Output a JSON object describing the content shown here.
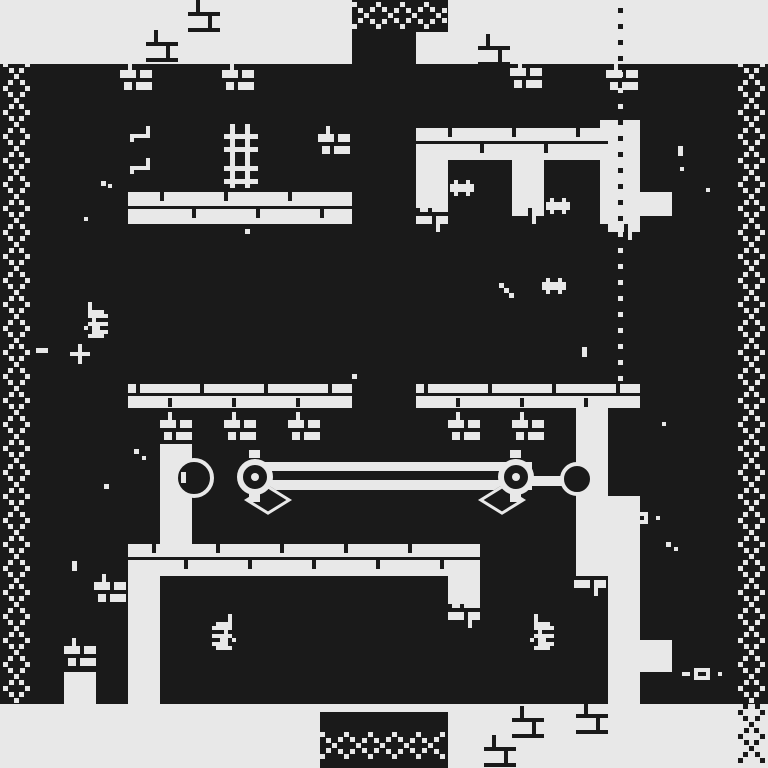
{
  "meta": {
    "title": "1-bit dungeon game screen",
    "description": "Monochrome pixel-art dungeon: brick corridors, chain borders, pulley mechanism, bat creatures, candelabras, keys, dotted route line"
  },
  "palette": {
    "light": "#e8e8e8",
    "dark": "#1a1a1a"
  },
  "regions": [
    {
      "name": "top-band",
      "x": 0,
      "y": 0,
      "w": 768,
      "h": 64,
      "c": "light"
    },
    {
      "name": "bottom-band",
      "x": 0,
      "y": 704,
      "w": 768,
      "h": 64,
      "c": "light"
    },
    {
      "name": "left-corridor",
      "x": 128,
      "y": 192,
      "w": 224,
      "h": 32,
      "c": "light"
    },
    {
      "name": "right-corridor",
      "x": 416,
      "y": 128,
      "w": 192,
      "h": 32,
      "c": "light"
    },
    {
      "name": "right-col-1",
      "x": 416,
      "y": 160,
      "w": 32,
      "h": 48,
      "c": "light"
    },
    {
      "name": "right-col-2",
      "x": 512,
      "y": 160,
      "w": 32,
      "h": 48,
      "c": "light"
    },
    {
      "name": "dot-corridor-top",
      "x": 600,
      "y": 120,
      "w": 40,
      "h": 104,
      "c": "light"
    },
    {
      "name": "left-platform",
      "x": 128,
      "y": 384,
      "w": 224,
      "h": 24,
      "c": "light"
    },
    {
      "name": "right-platform",
      "x": 416,
      "y": 384,
      "w": 224,
      "h": 24,
      "c": "light"
    },
    {
      "name": "mech-left-pillar",
      "x": 160,
      "y": 444,
      "w": 32,
      "h": 100,
      "c": "light"
    },
    {
      "name": "right-wall-col",
      "x": 576,
      "y": 400,
      "w": 32,
      "h": 176,
      "c": "light"
    },
    {
      "name": "dot-corridor-bottom",
      "x": 608,
      "y": 496,
      "w": 32,
      "h": 208,
      "c": "light"
    },
    {
      "name": "mid-band",
      "x": 128,
      "y": 544,
      "w": 352,
      "h": 32,
      "c": "light"
    },
    {
      "name": "bottom-left-col",
      "x": 128,
      "y": 576,
      "w": 32,
      "h": 128,
      "c": "light"
    },
    {
      "name": "bottom-right-col",
      "x": 448,
      "y": 544,
      "w": 32,
      "h": 60,
      "c": "light"
    },
    {
      "name": "right-block-a",
      "x": 640,
      "y": 192,
      "w": 32,
      "h": 24,
      "c": "light"
    },
    {
      "name": "right-block-b",
      "x": 640,
      "y": 640,
      "w": 32,
      "h": 32,
      "c": "light"
    },
    {
      "name": "left-pocket",
      "x": 64,
      "y": 672,
      "w": 32,
      "h": 32,
      "c": "light"
    },
    {
      "name": "top-chain-block",
      "x": 352,
      "y": 0,
      "w": 96,
      "h": 32,
      "c": "dark"
    },
    {
      "name": "center-col-stub",
      "x": 352,
      "y": 32,
      "w": 64,
      "h": 32,
      "c": "dark"
    },
    {
      "name": "bottom-chain-block",
      "x": 320,
      "y": 712,
      "w": 128,
      "h": 56,
      "c": "dark"
    }
  ],
  "bars": [
    {
      "name": "lattice-vbar",
      "x": 230,
      "y": 124,
      "w": 5,
      "h": 64,
      "c": "light"
    },
    {
      "name": "lattice-vbar",
      "x": 245,
      "y": 124,
      "w": 5,
      "h": 64,
      "c": "light"
    },
    {
      "name": "lattice-hbar",
      "x": 224,
      "y": 134,
      "w": 34,
      "h": 5,
      "c": "light"
    },
    {
      "name": "lattice-hbar",
      "x": 224,
      "y": 147,
      "w": 34,
      "h": 5,
      "c": "light"
    },
    {
      "name": "lattice-hbar",
      "x": 224,
      "y": 166,
      "w": 34,
      "h": 5,
      "c": "light"
    },
    {
      "name": "lattice-hbar",
      "x": 224,
      "y": 179,
      "w": 34,
      "h": 5,
      "c": "light"
    },
    {
      "name": "mortar-line",
      "x": 128,
      "y": 393,
      "w": 224,
      "h": 3,
      "c": "dark"
    },
    {
      "name": "mortar-line",
      "x": 416,
      "y": 393,
      "w": 224,
      "h": 3,
      "c": "dark"
    },
    {
      "name": "mortar-line",
      "x": 128,
      "y": 557,
      "w": 352,
      "h": 3,
      "c": "dark"
    },
    {
      "name": "mortar-line",
      "x": 128,
      "y": 206,
      "w": 224,
      "h": 3,
      "c": "dark"
    },
    {
      "name": "mortar-line",
      "x": 416,
      "y": 141,
      "w": 192,
      "h": 3,
      "c": "dark"
    },
    {
      "name": "mortar-tick",
      "x": 136,
      "y": 384,
      "w": 4,
      "h": 9,
      "c": "dark"
    },
    {
      "name": "mortar-tick",
      "x": 200,
      "y": 384,
      "w": 4,
      "h": 9,
      "c": "dark"
    },
    {
      "name": "mortar-tick",
      "x": 264,
      "y": 384,
      "w": 4,
      "h": 9,
      "c": "dark"
    },
    {
      "name": "mortar-tick",
      "x": 328,
      "y": 384,
      "w": 4,
      "h": 9,
      "c": "dark"
    },
    {
      "name": "mortar-tick",
      "x": 168,
      "y": 398,
      "w": 4,
      "h": 9,
      "c": "dark"
    },
    {
      "name": "mortar-tick",
      "x": 232,
      "y": 398,
      "w": 4,
      "h": 9,
      "c": "dark"
    },
    {
      "name": "mortar-tick",
      "x": 296,
      "y": 398,
      "w": 4,
      "h": 9,
      "c": "dark"
    },
    {
      "name": "mortar-tick",
      "x": 424,
      "y": 384,
      "w": 4,
      "h": 9,
      "c": "dark"
    },
    {
      "name": "mortar-tick",
      "x": 488,
      "y": 384,
      "w": 4,
      "h": 9,
      "c": "dark"
    },
    {
      "name": "mortar-tick",
      "x": 552,
      "y": 384,
      "w": 4,
      "h": 9,
      "c": "dark"
    },
    {
      "name": "mortar-tick",
      "x": 616,
      "y": 384,
      "w": 4,
      "h": 9,
      "c": "dark"
    },
    {
      "name": "mortar-tick",
      "x": 456,
      "y": 398,
      "w": 4,
      "h": 9,
      "c": "dark"
    },
    {
      "name": "mortar-tick",
      "x": 520,
      "y": 398,
      "w": 4,
      "h": 9,
      "c": "dark"
    },
    {
      "name": "mortar-tick",
      "x": 584,
      "y": 398,
      "w": 4,
      "h": 9,
      "c": "dark"
    },
    {
      "name": "mortar-tick",
      "x": 152,
      "y": 544,
      "w": 4,
      "h": 9,
      "c": "dark"
    },
    {
      "name": "mortar-tick",
      "x": 216,
      "y": 544,
      "w": 4,
      "h": 9,
      "c": "dark"
    },
    {
      "name": "mortar-tick",
      "x": 280,
      "y": 544,
      "w": 4,
      "h": 9,
      "c": "dark"
    },
    {
      "name": "mortar-tick",
      "x": 344,
      "y": 544,
      "w": 4,
      "h": 9,
      "c": "dark"
    },
    {
      "name": "mortar-tick",
      "x": 408,
      "y": 544,
      "w": 4,
      "h": 9,
      "c": "dark"
    },
    {
      "name": "mortar-tick",
      "x": 184,
      "y": 560,
      "w": 4,
      "h": 9,
      "c": "dark"
    },
    {
      "name": "mortar-tick",
      "x": 248,
      "y": 560,
      "w": 4,
      "h": 9,
      "c": "dark"
    },
    {
      "name": "mortar-tick",
      "x": 312,
      "y": 560,
      "w": 4,
      "h": 9,
      "c": "dark"
    },
    {
      "name": "mortar-tick",
      "x": 376,
      "y": 560,
      "w": 4,
      "h": 9,
      "c": "dark"
    },
    {
      "name": "mortar-tick",
      "x": 440,
      "y": 560,
      "w": 4,
      "h": 9,
      "c": "dark"
    },
    {
      "name": "mortar-tick",
      "x": 160,
      "y": 192,
      "w": 4,
      "h": 9,
      "c": "dark"
    },
    {
      "name": "mortar-tick",
      "x": 224,
      "y": 192,
      "w": 4,
      "h": 9,
      "c": "dark"
    },
    {
      "name": "mortar-tick",
      "x": 288,
      "y": 192,
      "w": 4,
      "h": 9,
      "c": "dark"
    },
    {
      "name": "mortar-tick",
      "x": 192,
      "y": 209,
      "w": 4,
      "h": 9,
      "c": "dark"
    },
    {
      "name": "mortar-tick",
      "x": 256,
      "y": 209,
      "w": 4,
      "h": 9,
      "c": "dark"
    },
    {
      "name": "mortar-tick",
      "x": 320,
      "y": 209,
      "w": 4,
      "h": 9,
      "c": "dark"
    },
    {
      "name": "mortar-tick",
      "x": 448,
      "y": 128,
      "w": 4,
      "h": 9,
      "c": "dark"
    },
    {
      "name": "mortar-tick",
      "x": 512,
      "y": 128,
      "w": 4,
      "h": 9,
      "c": "dark"
    },
    {
      "name": "mortar-tick",
      "x": 576,
      "y": 128,
      "w": 4,
      "h": 9,
      "c": "dark"
    },
    {
      "name": "mortar-tick",
      "x": 480,
      "y": 144,
      "w": 4,
      "h": 9,
      "c": "dark"
    },
    {
      "name": "mortar-tick",
      "x": 544,
      "y": 144,
      "w": 4,
      "h": 9,
      "c": "dark"
    },
    {
      "name": "rod-dash",
      "x": 36,
      "y": 348,
      "w": 12,
      "h": 5,
      "c": "light"
    }
  ],
  "patterns": {
    "ruin": [
      "..#.....",
      "..#.....",
      "..#.....",
      "########",
      ".....#..",
      ".....#..",
      ".....#..",
      "########"
    ],
    "brick": [
      "..#.....",
      "..#.....",
      "####.###",
      "####.###",
      "........",
      ".##.####",
      ".##.####"
    ],
    "brickf": [
      ".##.####",
      ".##.####",
      "........",
      "####.###",
      "####.###",
      ".....#..",
      ".....#.."
    ],
    "creature": [
      ".#..#.",
      "######",
      "######",
      ".#..#."
    ],
    "candelabra": [
      "....#.",
      "....#.",
      ".####.",
      "#####.",
      "...#..",
      "#####.",
      "..##.#",
      "####..",
      ".####."
    ],
    "candelabra_m": [
      ".#....",
      ".#....",
      ".####.",
      ".#####",
      "..#...",
      ".#####",
      "#.##..",
      "..####",
      ".####."
    ],
    "hook": [
      "....#",
      "....#",
      "#####",
      "#...."
    ],
    "key": [
      "...####...",
      "##.#..#..#",
      "...####..."
    ],
    "plus": [
      "..#..",
      "..#..",
      "#####",
      "..#..",
      "..#.."
    ],
    "streak": [
      "#...",
      ".#..",
      "..#.",
      "...#"
    ]
  },
  "sprites": [
    {
      "p": "ruin",
      "x": 188,
      "y": 0,
      "c": "dark"
    },
    {
      "p": "ruin",
      "x": 146,
      "y": 30,
      "c": "dark"
    },
    {
      "p": "ruin",
      "x": 478,
      "y": 34,
      "c": "dark"
    },
    {
      "p": "ruin",
      "x": 512,
      "y": 706,
      "c": "dark"
    },
    {
      "p": "ruin",
      "x": 576,
      "y": 702,
      "c": "dark"
    },
    {
      "p": "ruin",
      "x": 484,
      "y": 735,
      "c": "dark"
    },
    {
      "p": "brick",
      "x": 120,
      "y": 62,
      "c": "light"
    },
    {
      "p": "brick",
      "x": 222,
      "y": 62,
      "c": "light"
    },
    {
      "p": "brick",
      "x": 318,
      "y": 126,
      "c": "light"
    },
    {
      "p": "brick",
      "x": 606,
      "y": 62,
      "c": "light"
    },
    {
      "p": "brick",
      "x": 510,
      "y": 60,
      "c": "light"
    },
    {
      "p": "brick",
      "x": 160,
      "y": 412,
      "c": "light"
    },
    {
      "p": "brick",
      "x": 224,
      "y": 412,
      "c": "light"
    },
    {
      "p": "brick",
      "x": 288,
      "y": 412,
      "c": "light"
    },
    {
      "p": "brick",
      "x": 448,
      "y": 412,
      "c": "light"
    },
    {
      "p": "brick",
      "x": 512,
      "y": 412,
      "c": "light"
    },
    {
      "p": "brick",
      "x": 94,
      "y": 574,
      "c": "light"
    },
    {
      "p": "brick",
      "x": 64,
      "y": 638,
      "c": "light"
    },
    {
      "p": "brickf",
      "x": 416,
      "y": 204,
      "c": "light"
    },
    {
      "p": "brickf",
      "x": 512,
      "y": 196,
      "c": "light"
    },
    {
      "p": "brickf",
      "x": 608,
      "y": 212,
      "c": "light"
    },
    {
      "p": "brickf",
      "x": 448,
      "y": 600,
      "c": "light"
    },
    {
      "p": "brickf",
      "x": 574,
      "y": 568,
      "c": "light"
    },
    {
      "p": "creature",
      "x": 450,
      "y": 180,
      "c": "light"
    },
    {
      "p": "creature",
      "x": 546,
      "y": 198,
      "c": "light"
    },
    {
      "p": "creature",
      "x": 542,
      "y": 278,
      "c": "light"
    },
    {
      "p": "candelabra",
      "x": 212,
      "y": 614,
      "c": "light"
    },
    {
      "p": "candelabra_m",
      "x": 84,
      "y": 302,
      "c": "light"
    },
    {
      "p": "candelabra_m",
      "x": 530,
      "y": 614,
      "c": "light"
    },
    {
      "p": "hook",
      "x": 130,
      "y": 126,
      "c": "light"
    },
    {
      "p": "hook",
      "x": 130,
      "y": 158,
      "c": "light"
    },
    {
      "p": "key",
      "x": 620,
      "y": 512,
      "c": "light"
    },
    {
      "p": "key",
      "x": 682,
      "y": 668,
      "c": "light"
    },
    {
      "p": "plus",
      "x": 70,
      "y": 344,
      "c": "light"
    },
    {
      "p": "streak",
      "x": 494,
      "y": 278,
      "c": "light",
      "u": 5
    }
  ],
  "mechanism": {
    "rod_outer": {
      "x": 246,
      "y": 462,
      "w": 286,
      "h": 28
    },
    "rod_inner": {
      "x": 246,
      "y": 471,
      "w": 286,
      "h": 9
    },
    "link": {
      "x": 516,
      "y": 476,
      "w": 56,
      "h": 10
    },
    "glint": {
      "x": 181,
      "y": 472,
      "w": 5,
      "h": 11
    },
    "ball": {
      "x": 174,
      "y": 458,
      "d": 40,
      "border": 4
    },
    "pulley_a": {
      "x": 237,
      "y": 459,
      "d": 36,
      "border": 6,
      "dot": {
        "x": 251,
        "y": 473,
        "d": 8
      }
    },
    "pulley_b": {
      "x": 498,
      "y": 459,
      "d": 36,
      "border": 6,
      "dot": {
        "x": 512,
        "y": 473,
        "d": 8
      }
    },
    "end_ball": {
      "x": 560,
      "y": 462,
      "d": 34,
      "border": 4
    },
    "nubs": [
      {
        "x": 249,
        "y": 450,
        "w": 11,
        "h": 8
      },
      {
        "x": 249,
        "y": 494,
        "w": 11,
        "h": 8
      },
      {
        "x": 510,
        "y": 450,
        "w": 11,
        "h": 8
      },
      {
        "x": 510,
        "y": 494,
        "w": 11,
        "h": 8
      }
    ],
    "diamonds": [
      {
        "cx": 268,
        "cy": 500,
        "s": 34
      },
      {
        "cx": 502,
        "cy": 500,
        "s": 34
      }
    ]
  },
  "chains": [
    {
      "name": "left-edge-chain",
      "dir": "v",
      "center": 16,
      "from": 64,
      "to": 702,
      "segments": [
        {
          "a": 64,
          "b": 702,
          "c": "light"
        }
      ]
    },
    {
      "name": "right-edge-chain",
      "dir": "v",
      "center": 751,
      "from": 64,
      "to": 764,
      "segments": [
        {
          "a": 64,
          "b": 700,
          "c": "light"
        },
        {
          "a": 700,
          "b": 764,
          "c": "dark"
        }
      ]
    },
    {
      "name": "top-chain",
      "dir": "h",
      "center": 15,
      "from": 354,
      "to": 445,
      "segments": [
        {
          "a": 354,
          "b": 445,
          "c": "light"
        }
      ]
    },
    {
      "name": "bottom-chain",
      "dir": "h",
      "center": 745,
      "from": 322,
      "to": 445,
      "segments": [
        {
          "a": 322,
          "b": 445,
          "c": "light"
        }
      ]
    }
  ],
  "chain_style": {
    "amplitude": 11,
    "period": 48,
    "step": 6,
    "dot": 5
  },
  "dotline": {
    "x": 618,
    "y_from": 8,
    "y_to": 388,
    "step": 16,
    "dot": 5,
    "dark_spans": [
      [
        0,
        62
      ],
      [
        110,
        222
      ]
    ]
  },
  "sparkles": [
    {
      "x": 101,
      "y": 181,
      "w": 5,
      "h": 5,
      "c": "light"
    },
    {
      "x": 108,
      "y": 184,
      "w": 4,
      "h": 4,
      "c": "light"
    },
    {
      "x": 84,
      "y": 217,
      "w": 4,
      "h": 4,
      "c": "light"
    },
    {
      "x": 245,
      "y": 229,
      "w": 5,
      "h": 5,
      "c": "light"
    },
    {
      "x": 352,
      "y": 374,
      "w": 5,
      "h": 5,
      "c": "light"
    },
    {
      "x": 134,
      "y": 449,
      "w": 5,
      "h": 5,
      "c": "light"
    },
    {
      "x": 142,
      "y": 456,
      "w": 4,
      "h": 4,
      "c": "light"
    },
    {
      "x": 104,
      "y": 484,
      "w": 5,
      "h": 5,
      "c": "light"
    },
    {
      "x": 72,
      "y": 561,
      "w": 5,
      "h": 10,
      "c": "light"
    },
    {
      "x": 582,
      "y": 347,
      "w": 5,
      "h": 10,
      "c": "light"
    },
    {
      "x": 678,
      "y": 146,
      "w": 5,
      "h": 10,
      "c": "light"
    },
    {
      "x": 662,
      "y": 422,
      "w": 4,
      "h": 4,
      "c": "light"
    },
    {
      "x": 680,
      "y": 167,
      "w": 4,
      "h": 4,
      "c": "light"
    },
    {
      "x": 706,
      "y": 188,
      "w": 4,
      "h": 4,
      "c": "light"
    },
    {
      "x": 666,
      "y": 542,
      "w": 5,
      "h": 5,
      "c": "light"
    },
    {
      "x": 674,
      "y": 547,
      "w": 4,
      "h": 4,
      "c": "light"
    }
  ]
}
